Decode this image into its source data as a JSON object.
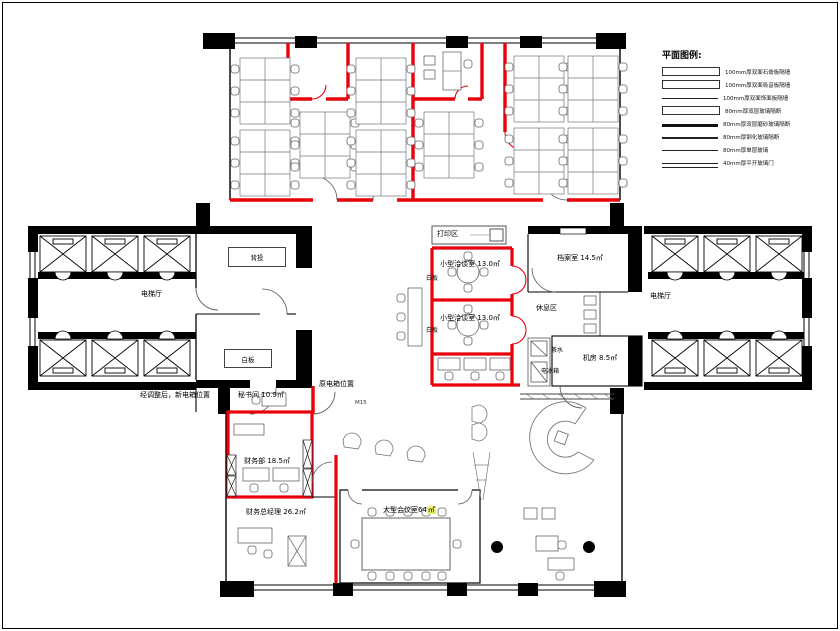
{
  "colors": {
    "new_wall_red": "#e8000a",
    "structure_black": "#000000",
    "thin_line": "#444444",
    "highlight_yellow": "#f3f36e"
  },
  "legend": {
    "title": "平面图例:",
    "items": [
      {
        "label": "100mm厚双面石膏板隔墙",
        "swatch": "rect-outline"
      },
      {
        "label": "100mm厚双面吸音板隔墙",
        "swatch": "rect-outline"
      },
      {
        "label": "100mm厚双面饰面板隔墙",
        "swatch": "line"
      },
      {
        "label": "80mm厚双层玻璃隔断",
        "swatch": "rect-outline"
      },
      {
        "label": "80mm厚双层磨砂玻璃隔断",
        "swatch": "thick-line"
      },
      {
        "label": "80mm厚钢化玻璃隔断",
        "swatch": "medium-line"
      },
      {
        "label": "80mm厚单层玻璃",
        "swatch": "thin-line"
      },
      {
        "label": "40mm厚平开玻璃门",
        "swatch": "double-line"
      }
    ]
  },
  "rooms": {
    "print_area": {
      "label": "打印区"
    },
    "meeting_small_1": {
      "label": "小型洽谈室",
      "area": "13.0㎡"
    },
    "meeting_small_2": {
      "label": "小型洽谈室",
      "area": "13.0㎡"
    },
    "whiteboard_1": {
      "label": "白板"
    },
    "whiteboard_2": {
      "label": "白板"
    },
    "archive": {
      "label": "档案室",
      "area": "14.5㎡"
    },
    "rest_area": {
      "label": "休息区"
    },
    "tea_water": {
      "label": "茶水"
    },
    "fridge": {
      "label": "电冰箱"
    },
    "machine_room": {
      "label": "机房",
      "area": "8.5㎡"
    },
    "elevator_hall_left": {
      "label": "电梯厅"
    },
    "elevator_hall_right": {
      "label": "电梯厅"
    },
    "rear_projection": {
      "label": "背投"
    },
    "whiteboard_box": {
      "label": "白板"
    },
    "secretary": {
      "label": "秘书间",
      "area": "10.9㎡"
    },
    "finance": {
      "label": "财务部",
      "area": "18.5㎡"
    },
    "finance_director": {
      "label": "财务总经理",
      "area": "26.2㎡"
    },
    "big_meeting": {
      "label": "大型会议室64",
      "highlight": "㎡"
    }
  },
  "annotations": {
    "new_box_note": "经调整后，新电箱位置",
    "old_box_note": "原电箱位置",
    "door_tag": "M15"
  }
}
